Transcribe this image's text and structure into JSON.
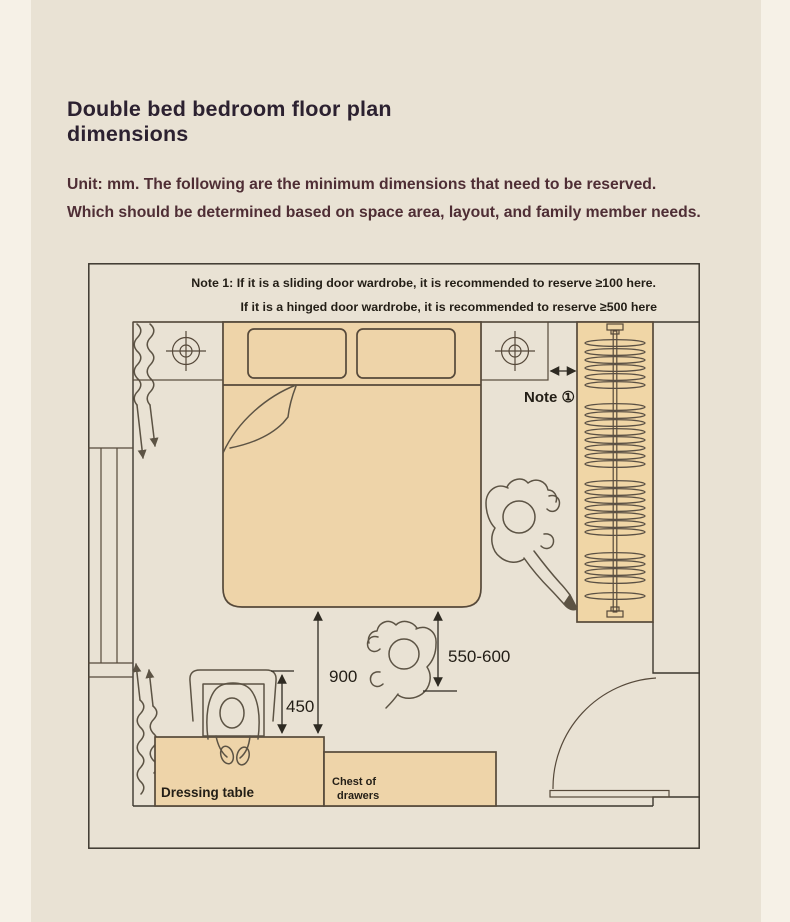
{
  "page": {
    "title_line1": "Double bed bedroom floor plan",
    "title_line2": "dimensions",
    "subtitle_line1": "Unit: mm. The following are the minimum dimensions that need to be reserved.",
    "subtitle_line2": "Which should be determined based on space area, layout, and family member needs."
  },
  "plan": {
    "note1": "Note 1: If it is a sliding door wardrobe, it is recommended to reserve ≥100 here.",
    "note2": "If it is a hinged door wardrobe, it is recommended to reserve ≥500 here",
    "note_marker": "Note ①",
    "dim_bed_to_table": "900",
    "dim_chair_clearance": "450",
    "dim_bed_to_wardrobe_side": "550-600",
    "label_dressing_table": "Dressing table",
    "label_chest_line1": "Chest of",
    "label_chest_line2": "drawers",
    "wardrobe_hanger_rows": [
      343,
      352,
      360,
      368,
      377,
      385,
      407,
      415,
      423,
      432,
      440,
      448,
      456,
      464,
      484,
      492,
      500,
      508,
      516,
      524,
      532,
      556,
      564,
      572,
      580,
      596
    ]
  },
  "colors": {
    "background": "#e9e2d4",
    "margin_strip": "#f6f1e7",
    "furniture_fill": "#eed4a9",
    "wall_line": "#3c372e",
    "title_text": "#2c2130",
    "body_text": "#4f2e35",
    "plan_text": "#231e16"
  }
}
